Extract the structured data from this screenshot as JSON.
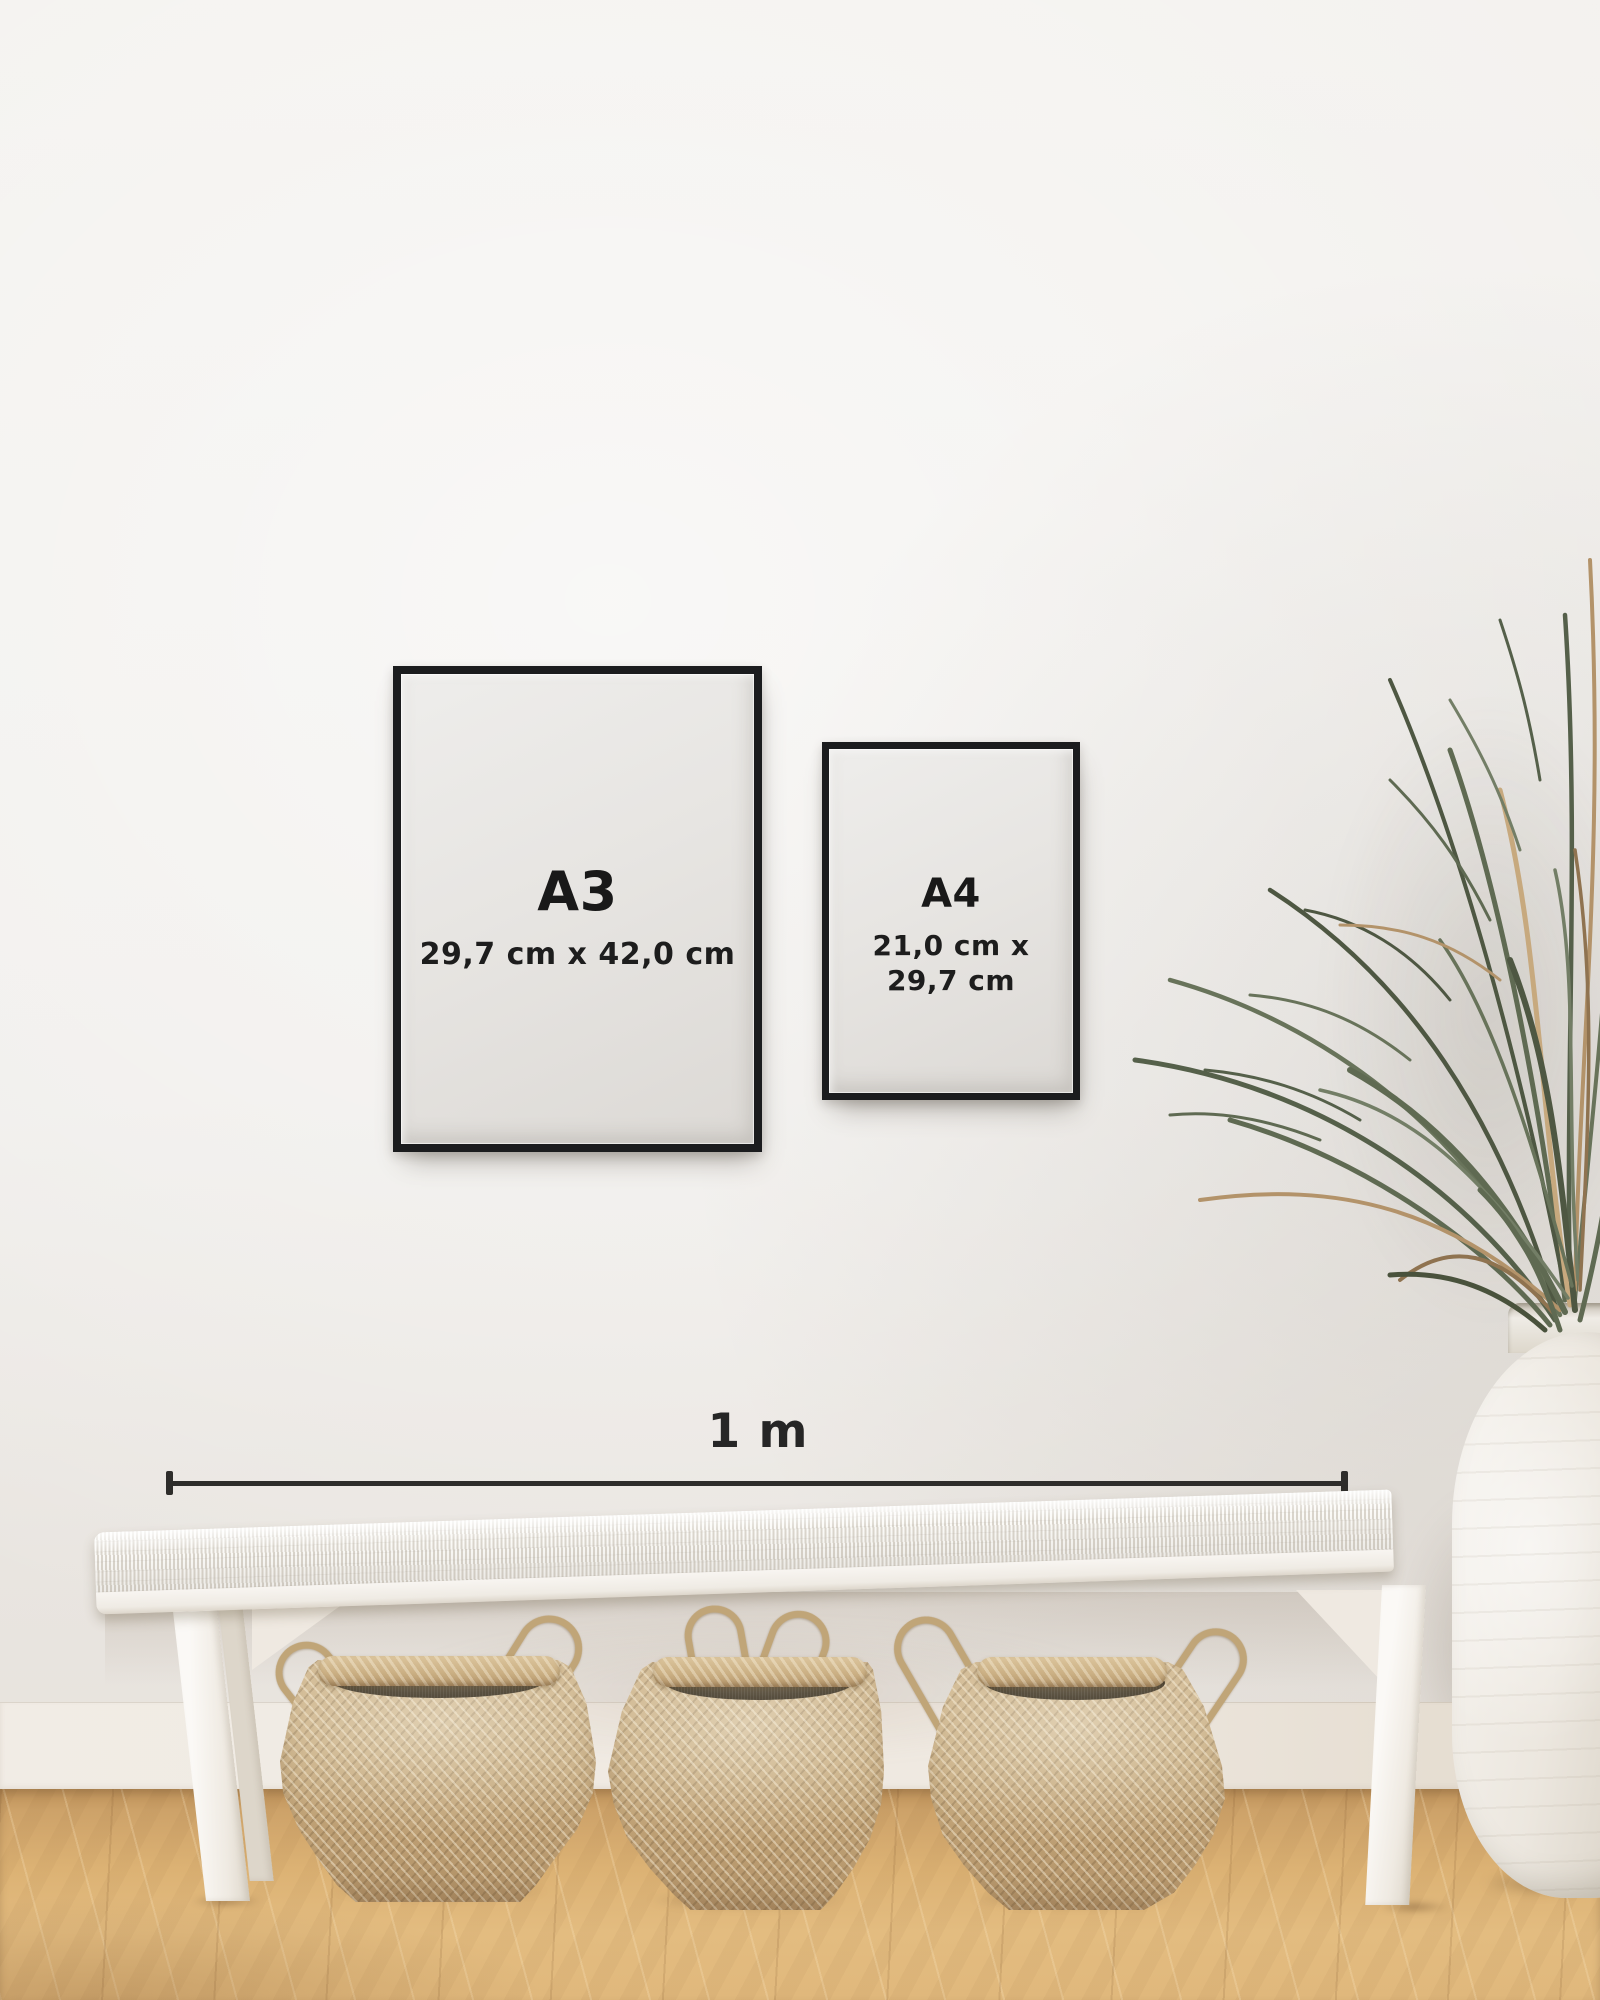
{
  "page": {
    "title": "Poster frame size guide mockup"
  },
  "frames": [
    {
      "id": "a3",
      "label": "A3",
      "dimensions": "29,7 cm x 42,0 cm"
    },
    {
      "id": "a4",
      "label": "A4",
      "dimensions_line1": "21,0 cm x",
      "dimensions_line2": "29,7 cm"
    }
  ],
  "scale": {
    "label": "1 m"
  },
  "colors": {
    "wall": "#f1efec",
    "frame_black": "#1b1c1e",
    "paper": "#e7e4e1",
    "text": "#1b1b1b",
    "scale_line": "#2e2d2b",
    "floor_wood": "#dcb274",
    "basket_weave": "#c3a87d",
    "bench_white": "#f7f4ef",
    "vase_white": "#e9e4dc",
    "plant_green": "#5f6a52",
    "plant_dry": "#b3936a"
  },
  "decor": {
    "bench": "white woven bench",
    "baskets": [
      "seagrass belly basket",
      "seagrass belly basket",
      "seagrass belly basket"
    ],
    "vase": "white ceramic urn",
    "plant": "dried palm plant"
  }
}
